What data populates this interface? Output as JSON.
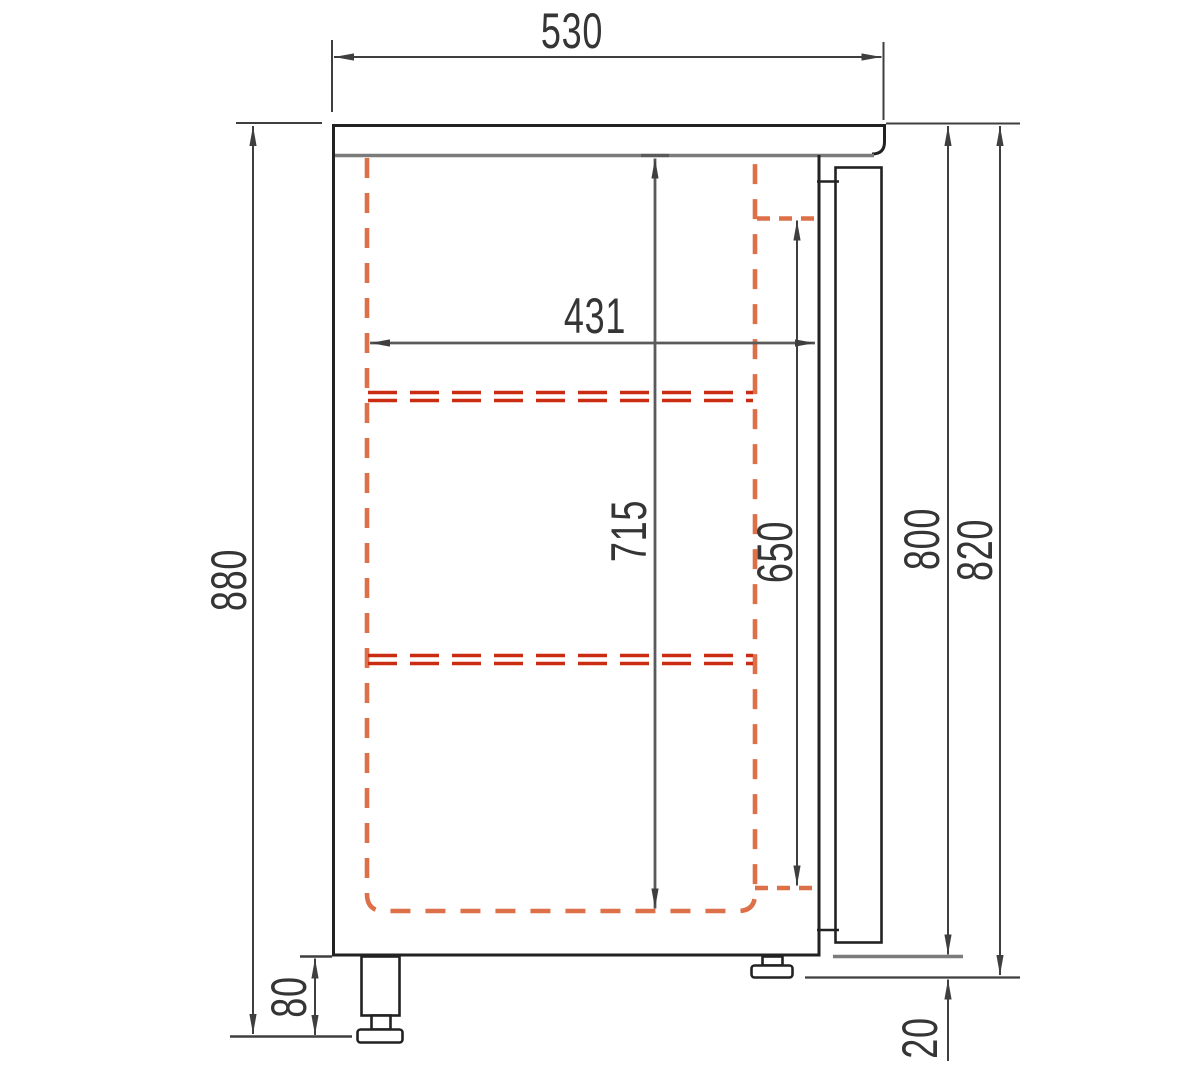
{
  "dimensions": {
    "top_width": "530",
    "overall_height": "880",
    "interior_depth": "431",
    "interior_height": "715",
    "door_interior_height": "650",
    "body_height": "800",
    "body_with_feet_height": "820",
    "leg_height": "80",
    "foot_height": "20"
  },
  "colors": {
    "outline": "#222222",
    "dimension_lines": "#3f3f3f",
    "inner_dimension_lines": "#5a5a5a",
    "liner_dashed": "#dd7048",
    "shelf_dashed": "#c92c10",
    "worktop_underside_gray": "#7b7b7b",
    "background": "#ffffff"
  }
}
